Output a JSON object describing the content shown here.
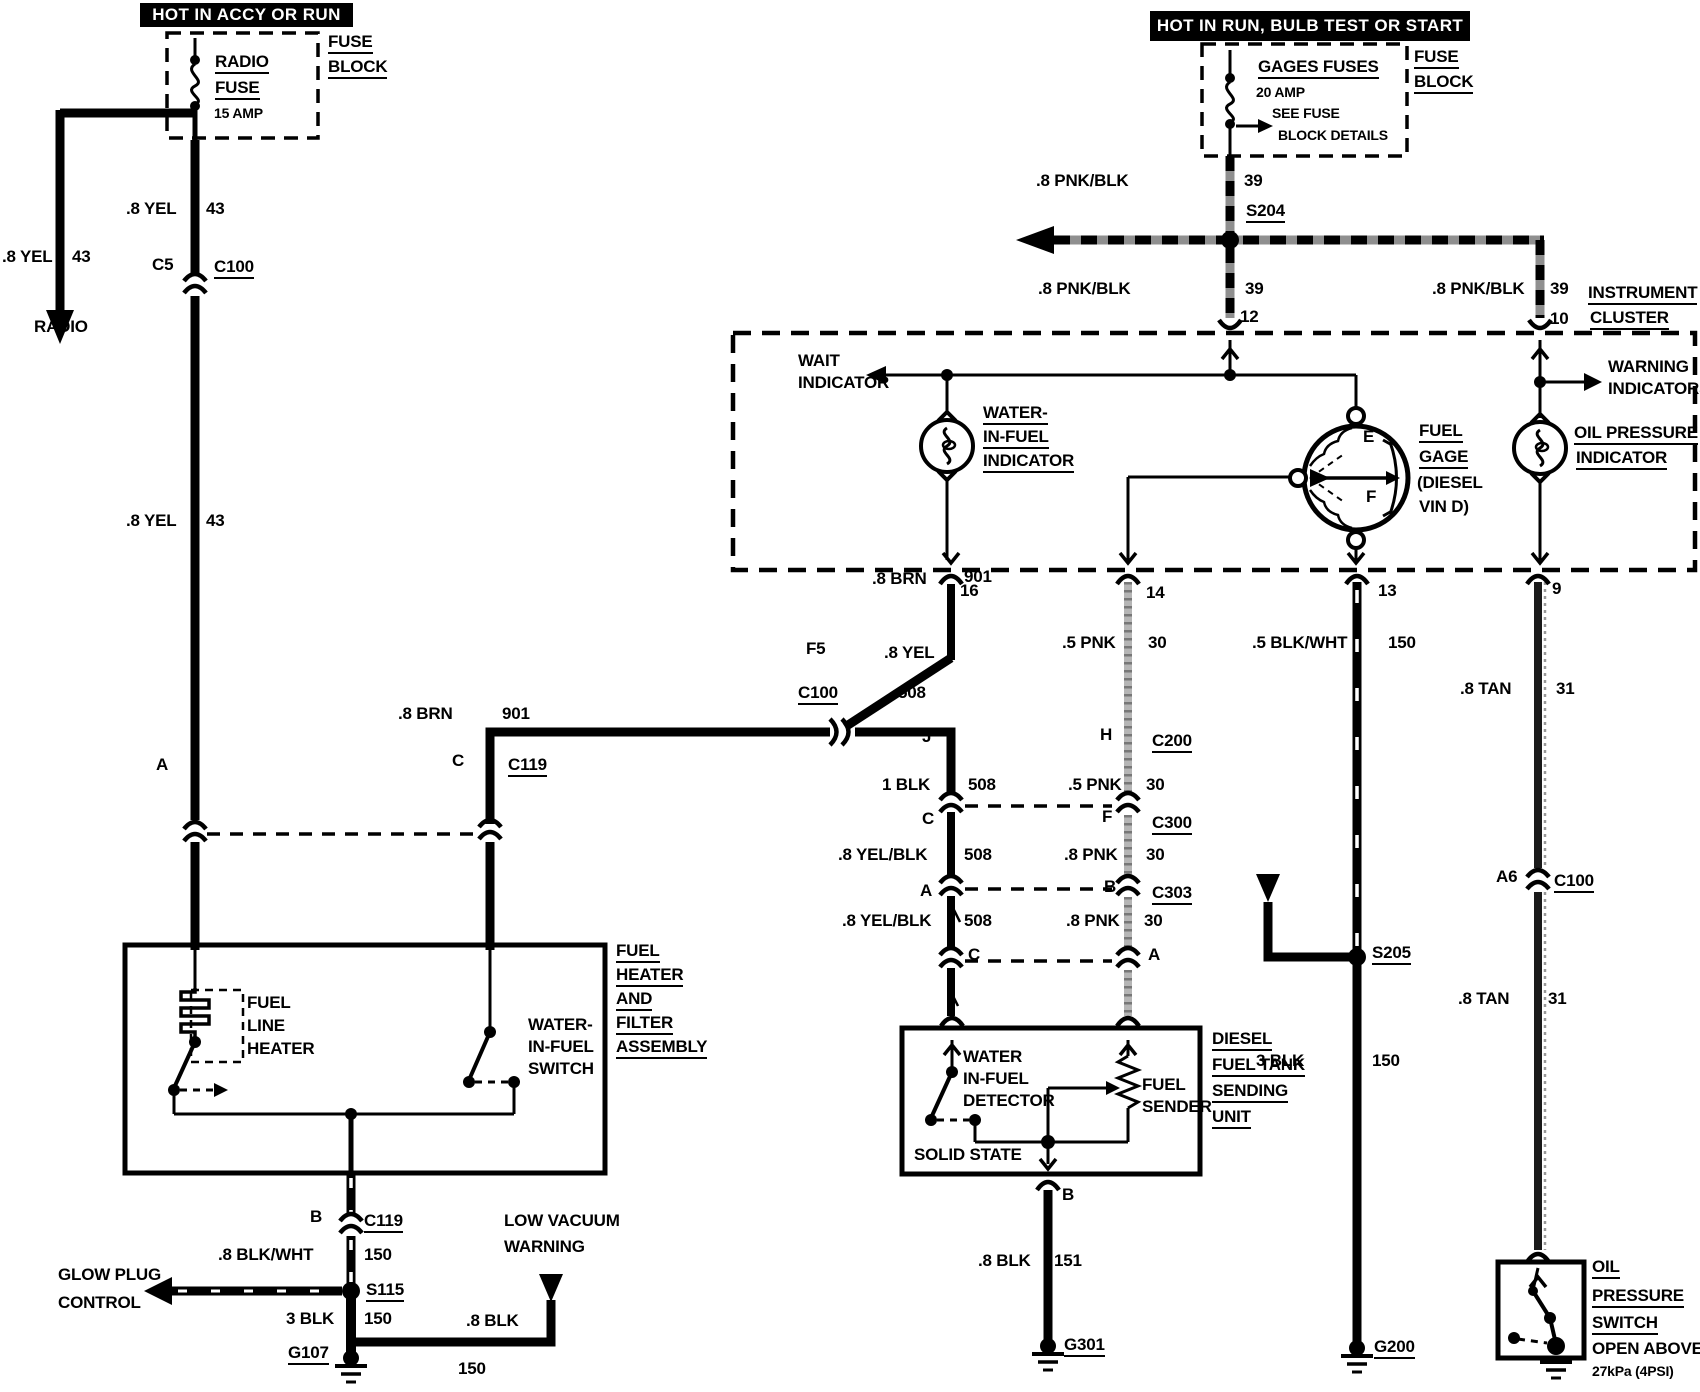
{
  "colors": {
    "ink": "#000000",
    "paper": "#ffffff",
    "gray_wire": "#9a9a9a"
  },
  "labels": {
    "banner_accy": "HOT IN ACCY OR RUN",
    "banner_run": "HOT IN RUN, BULB TEST OR START",
    "radio_fuse1": "RADIO",
    "radio_fuse2": "FUSE",
    "radio_fuse_amp": "15 AMP",
    "fuseblk_l1": "FUSE",
    "fuseblk_l2": "BLOCK",
    "gages_title": "GAGES FUSES",
    "gages_amp": "20 AMP",
    "gages_note1": "SEE FUSE",
    "gages_note2": "BLOCK DETAILS",
    "fuseblk_r1": "FUSE",
    "fuseblk_r2": "BLOCK",
    "w_yel_radio": ".8 YEL",
    "n_yel_radio": "43",
    "radio_dest": "RADIO",
    "w_yel_1": ".8 YEL",
    "n_yel_1": "43",
    "pin_c5": "C5",
    "conn_c100_top": "C100",
    "w_yel_2": ".8 YEL",
    "n_yel_2": "43",
    "pin_a_left": "A",
    "w_brn_1": ".8 BRN",
    "n_brn_1": "901",
    "pin_c119_c": "C",
    "conn_c119": "C119",
    "pin_f5": "F5",
    "conn_c100_mid": "C100",
    "w_brn_2": ".8 BRN",
    "n_brn_2": "901",
    "w_yel_3": ".8 YEL",
    "n_yel_3": "508",
    "pin_j": "J",
    "pin_h": "H",
    "conn_c200": "C200",
    "w_blk_1": "1 BLK",
    "n_blk_1": "508",
    "pin_c_mid": "C",
    "pin_f_mid": "F",
    "conn_c300": "C300",
    "w_yelblk_1": ".8 YEL/BLK",
    "n_yelblk_1": "508",
    "pin_a_mid": "A",
    "pin_b_mid": "B",
    "conn_c303": "C303",
    "w_yelblk_2": ".8 YEL/BLK",
    "n_yelblk_2": "508",
    "pin_c_tank": "C",
    "pin_a_tank": "A",
    "w_pnk_1": ".5 PNK",
    "n_pnk_1": "30",
    "w_pnk_2": ".5 PNK",
    "n_pnk_2": "30",
    "w_pnk_3": ".8 PNK",
    "n_pnk_3": "30",
    "w_pnk_4": ".8 PNK",
    "n_pnk_4": "30",
    "w_blkwht_1": ".5 BLK/WHT",
    "n_blkwht_1": "150",
    "splice_s205": "S205",
    "w_blk_2": "3 BLK",
    "n_blk_2": "150",
    "gnd_g200": "G200",
    "w_tan_1": ".8 TAN",
    "n_tan_1": "31",
    "pin_a6": "A6",
    "conn_c100_right": "C100",
    "w_tan_2": ".8 TAN",
    "n_tan_2": "31",
    "w_pnkblk_1": ".8 PNK/BLK",
    "n_pnkblk_1": "39",
    "splice_s204": "S204",
    "w_pnkblk_2": ".8 PNK/BLK",
    "n_pnkblk_2": "39",
    "w_pnkblk_3": ".8 PNK/BLK",
    "n_pnkblk_3": "39",
    "cluster1": "INSTRUMENT",
    "cluster2": "CLUSTER",
    "pin_12": "12",
    "pin_10": "10",
    "pin_16": "16",
    "pin_14": "14",
    "pin_13": "13",
    "pin_9": "9",
    "wait1": "WAIT",
    "wait2": "INDICATOR",
    "wif_ind1": "WATER-",
    "wif_ind2": "IN-FUEL",
    "wif_ind3": "INDICATOR",
    "gage_e": "E",
    "gage_f": "F",
    "fuelgage1": "FUEL",
    "fuelgage2": "GAGE",
    "fuelgage3": "(DIESEL",
    "fuelgage4": "VIN D)",
    "warn1": "WARNING",
    "warn2": "INDICATORS",
    "oil_ind1": "OIL PRESSURE",
    "oil_ind2": "INDICATOR",
    "tank1": "DIESEL",
    "tank2": "FUEL TANK",
    "tank3": "SENDING",
    "tank4": "UNIT",
    "det1": "WATER",
    "det2": "IN-FUEL",
    "det3": "DETECTOR",
    "sender1": "FUEL",
    "sender2": "SENDER",
    "solid_state": "SOLID STATE",
    "pin_b_tank": "B",
    "w_blk_3": ".8 BLK",
    "n_blk_3": "151",
    "gnd_g301": "G301",
    "heater1": "FUEL",
    "heater2": "LINE",
    "heater3": "HEATER",
    "wif_sw1": "WATER-",
    "wif_sw2": "IN-FUEL",
    "wif_sw3": "SWITCH",
    "assy1": "FUEL",
    "assy2": "HEATER",
    "assy3": "AND",
    "assy4": "FILTER",
    "assy5": "ASSEMBLY",
    "pin_b_c119": "B",
    "conn_c119_b": "C119",
    "w_blkwht_2": ".8 BLK/WHT",
    "n_blkwht_2": "150",
    "glow1": "GLOW PLUG",
    "glow2": "CONTROL",
    "splice_s115": "S115",
    "w_blk_4": "3 BLK",
    "n_blk_4": "150",
    "gnd_g107": "G107",
    "lowvac1": "LOW VACUUM",
    "lowvac2": "WARNING",
    "w_blk_5": ".8 BLK",
    "n_blk_5": "150",
    "oilsw1": "OIL",
    "oilsw2": "PRESSURE",
    "oilsw3": "SWITCH",
    "oilsw4": "OPEN ABOVE",
    "oilsw5": "27kPa (4PSI)"
  }
}
